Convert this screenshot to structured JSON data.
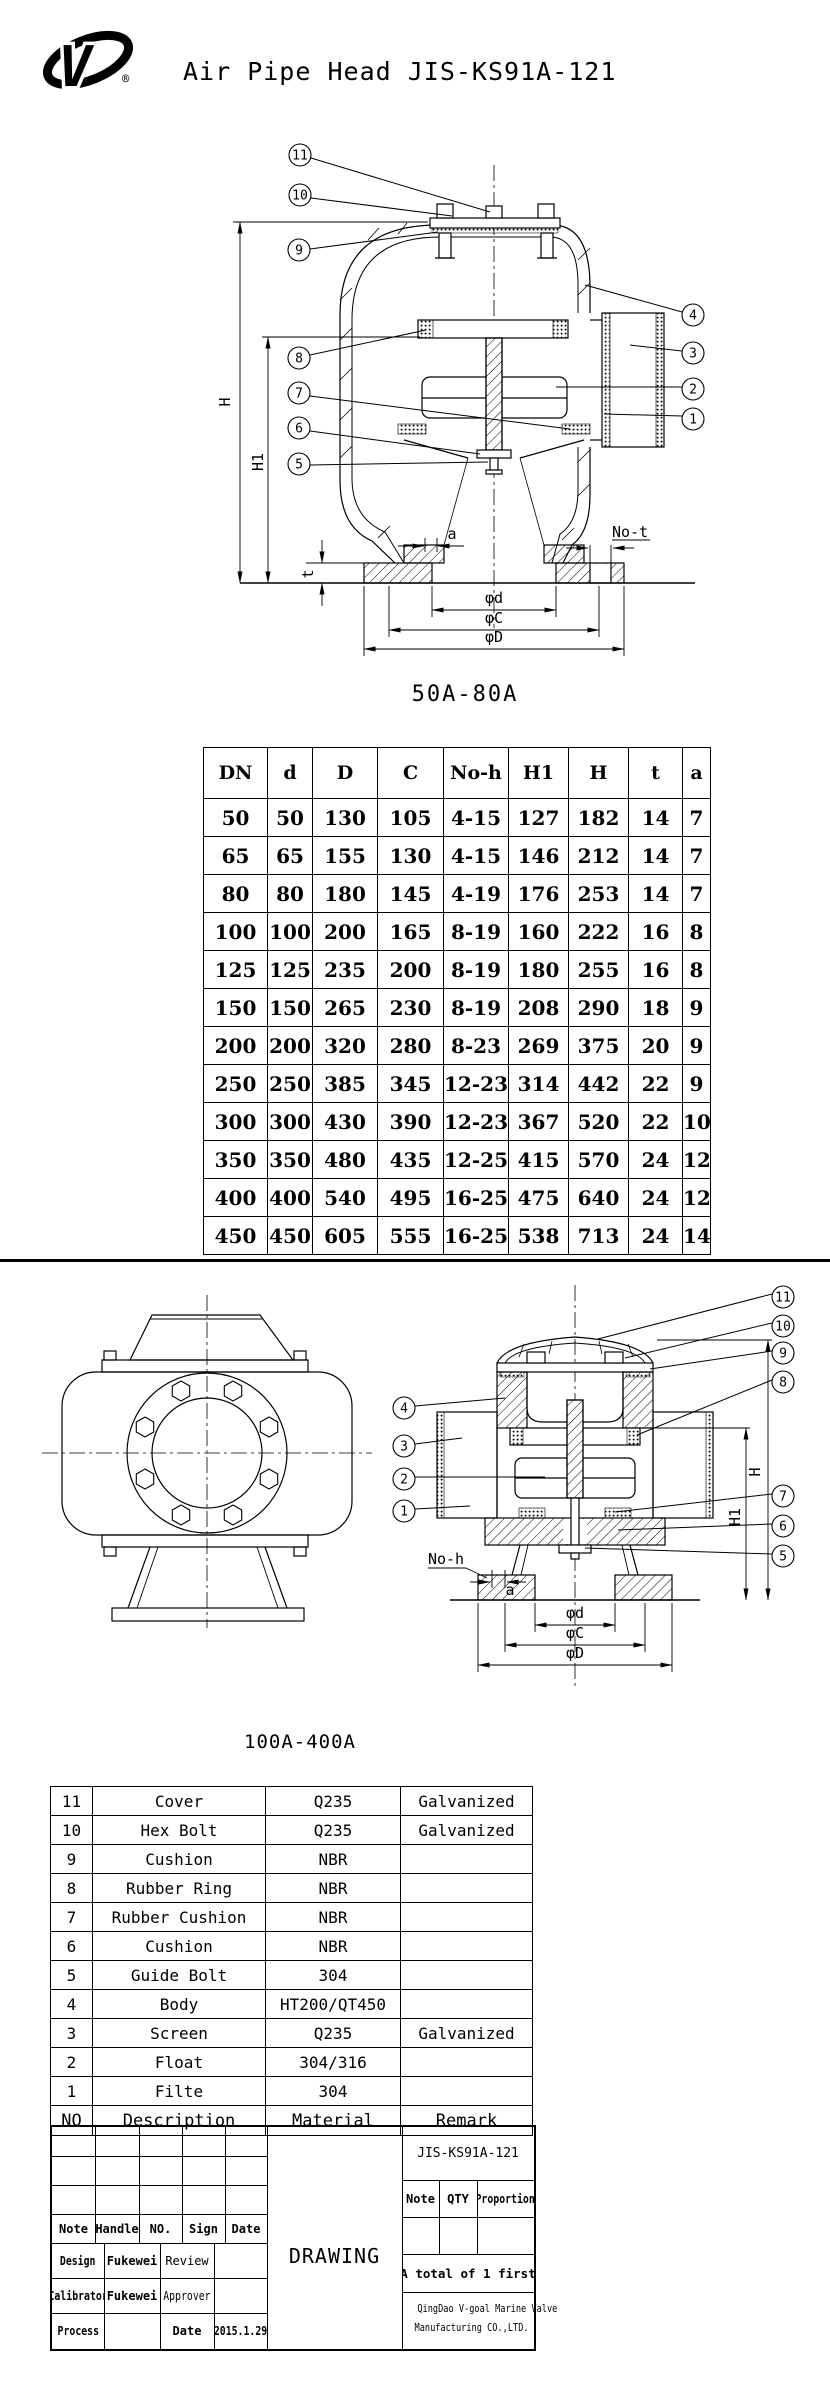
{
  "header": {
    "title": "Air Pipe Head JIS-KS91A-121",
    "logo_letter": "V",
    "registered_mark": "®"
  },
  "drawing_50a": {
    "caption": "50A-80A",
    "callouts": {
      "c11": "11",
      "c10": "10",
      "c9": "9",
      "c8": "8",
      "c7": "7",
      "c6": "6",
      "c5": "5",
      "c4": "4",
      "c3": "3",
      "c2": "2",
      "c1": "1"
    },
    "dims": {
      "H": "H",
      "H1": "H1",
      "t": "t",
      "a": "a",
      "not": "No-t",
      "phid": "φd",
      "phic": "φC",
      "phiD": "φD"
    }
  },
  "dim_table": {
    "headers": [
      "DN",
      "d",
      "D",
      "C",
      "No-h",
      "H1",
      "H",
      "t",
      "a"
    ],
    "rows": [
      [
        "50",
        "50",
        "130",
        "105",
        "4-15",
        "127",
        "182",
        "14",
        "7"
      ],
      [
        "65",
        "65",
        "155",
        "130",
        "4-15",
        "146",
        "212",
        "14",
        "7"
      ],
      [
        "80",
        "80",
        "180",
        "145",
        "4-19",
        "176",
        "253",
        "14",
        "7"
      ],
      [
        "100",
        "100",
        "200",
        "165",
        "8-19",
        "160",
        "222",
        "16",
        "8"
      ],
      [
        "125",
        "125",
        "235",
        "200",
        "8-19",
        "180",
        "255",
        "16",
        "8"
      ],
      [
        "150",
        "150",
        "265",
        "230",
        "8-19",
        "208",
        "290",
        "18",
        "9"
      ],
      [
        "200",
        "200",
        "320",
        "280",
        "8-23",
        "269",
        "375",
        "20",
        "9"
      ],
      [
        "250",
        "250",
        "385",
        "345",
        "12-23",
        "314",
        "442",
        "22",
        "9"
      ],
      [
        "300",
        "300",
        "430",
        "390",
        "12-23",
        "367",
        "520",
        "22",
        "10"
      ],
      [
        "350",
        "350",
        "480",
        "435",
        "12-25",
        "415",
        "570",
        "24",
        "12"
      ],
      [
        "400",
        "400",
        "540",
        "495",
        "16-25",
        "475",
        "640",
        "24",
        "12"
      ],
      [
        "450",
        "450",
        "605",
        "555",
        "16-25",
        "538",
        "713",
        "24",
        "14"
      ]
    ]
  },
  "drawing_100a": {
    "caption": "100A-400A",
    "callouts": {
      "c11": "11",
      "c10": "10",
      "c9": "9",
      "c8": "8",
      "c7": "7",
      "c6": "6",
      "c5": "5",
      "c4": "4",
      "c3": "3",
      "c2": "2",
      "c1": "1"
    },
    "dims": {
      "H": "H",
      "H1": "H1",
      "a": "a",
      "noh": "No-h",
      "phid": "φd",
      "phic": "φC",
      "phiD": "φD"
    }
  },
  "parts_table": {
    "headers": [
      "NO",
      "Description",
      "Material",
      "Remark"
    ],
    "rows": [
      [
        "11",
        "Cover",
        "Q235",
        "Galvanized"
      ],
      [
        "10",
        "Hex Bolt",
        "Q235",
        "Galvanized"
      ],
      [
        "9",
        "Cushion",
        "NBR",
        ""
      ],
      [
        "8",
        "Rubber Ring",
        "NBR",
        ""
      ],
      [
        "7",
        "Rubber Cushion",
        "NBR",
        ""
      ],
      [
        "6",
        "Cushion",
        "NBR",
        ""
      ],
      [
        "5",
        "Guide Bolt",
        "304",
        ""
      ],
      [
        "4",
        "Body",
        "HT200/QT450",
        ""
      ],
      [
        "3",
        "Screen",
        "Q235",
        "Galvanized"
      ],
      [
        "2",
        "Float",
        "304/316",
        ""
      ],
      [
        "1",
        "Filte",
        "304",
        ""
      ]
    ]
  },
  "title_block": {
    "drawing_no": "JIS-KS91A-121",
    "sign_headers": [
      "Note",
      "Handle",
      "NO.",
      "Sign",
      "Date"
    ],
    "design_label": "Design",
    "design_name": "Fukewei",
    "review_label": "Review",
    "calibrator_label": "Calibrator",
    "calibrator_name": "Fukewei",
    "approver_label": "Approver",
    "process_label": "Process",
    "date_label": "Date",
    "date_value": "2015.1.29",
    "center_label": "DRAWING",
    "qty_headers": [
      "Note",
      "QTY",
      "Proportion"
    ],
    "total_note": "A total of 1 first",
    "company_line1": "QingDao V-goal Marine Valve",
    "company_line2": "Manufacturing CO.,LTD."
  },
  "colors": {
    "ink": "#000000",
    "paper": "#ffffff"
  }
}
